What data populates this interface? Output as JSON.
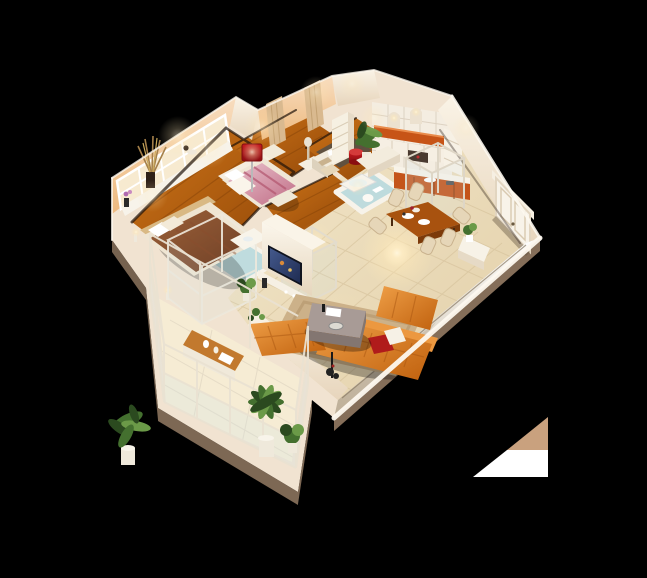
{
  "scene": {
    "type": "3d-isometric-apartment-cutaway-render",
    "view": "dollhouse-from-above",
    "background": "#000000"
  },
  "palette": {
    "bg": "#000000",
    "wall_cream": "#f1e3d1",
    "wall_bright": "#fcf8f0",
    "wall_peach": "#f4cba2",
    "wall_shade": "#cdab88",
    "slab_shade": "#937a63",
    "wood": "#b45f10",
    "wood_dark": "#7c3d07",
    "tile": "#ecdcbd",
    "tile_light": "#f6ecd4",
    "grout": "#d6c29c",
    "tile_blue": "#bedbdd",
    "rug": "#ccb189",
    "rug_dark": "#b2946a",
    "sofa": "#d97a26",
    "sofa_dark": "#a5520e",
    "grey_table": "#a89b96",
    "grey_table_dark": "#837671",
    "dining_wood": "#a8520f",
    "chair": "#e6d6b8",
    "chair_dark": "#c9b28e",
    "kitchen_orange": "#c4541a",
    "cornice": "#c75417",
    "lamp_red": "#ab1218",
    "bed_brown": "#7d4a2e",
    "bed_pink": "#d07b92",
    "white": "#f7f3ea",
    "plant": "#44702f",
    "plant_dark": "#2b4a1f",
    "plant_light": "#6b9a48",
    "glass": "#cfe3e8",
    "tv": "#10141f",
    "shadow": "#20130a",
    "glow": "#fff3d8",
    "artifact_tan": "#c9a17e",
    "artifact_white": "#ffffff"
  },
  "rooms": [
    {
      "name": "master-bedroom",
      "floor": "orange-wood",
      "furniture": [
        "double-bed-brown-cover",
        "glass-canopy-frame",
        "bedside-lamps",
        "window-wall-with-plants",
        "wardrobe"
      ]
    },
    {
      "name": "second-bedroom",
      "floor": "orange-wood",
      "furniture": [
        "double-bed-pink-cover",
        "red-floor-lamp",
        "curtains",
        "dresser-with-mirror"
      ]
    },
    {
      "name": "study",
      "floor": "orange-wood",
      "furniture": [
        "desk",
        "chair",
        "white-shelf-unit",
        "red-drum-stool",
        "potted-plant",
        "dark-area-rug",
        "low-cabinet"
      ]
    },
    {
      "name": "kitchen",
      "floor": "beige-tile",
      "furniture": [
        "tiled-backsplash-with-arched-niches",
        "orange-cornice",
        "upper-cabinets",
        "orange-lower-cabinets",
        "counter",
        "glass-cubicle",
        "pantry-shelves"
      ]
    },
    {
      "name": "bathroom",
      "floor": "blue-tile",
      "furniture": [
        "bathtub",
        "toilet"
      ]
    },
    {
      "name": "ensuite-bathroom",
      "floor": "blue-mosaic-tile",
      "furniture": [
        "glass-shower-cubicle",
        "vanity-basin"
      ]
    },
    {
      "name": "dining-area",
      "floor": "beige-tile",
      "furniture": [
        "wooden-dining-table",
        "six-upholstered-chairs",
        "tableware"
      ]
    },
    {
      "name": "living-room",
      "floor": "beige-tile",
      "furniture": [
        "l-shaped-orange-sofa",
        "ottoman-sectional",
        "grey-coffee-table",
        "beige-area-rug",
        "tv-on-partition-wall",
        "media-console",
        "red-and-white-pillows",
        "floor-sculpture"
      ]
    },
    {
      "name": "balcony",
      "floor": "light-tile",
      "furniture": [
        "glass-and-frame-railing",
        "wooden-bench-with-decor",
        "large-potted-plants"
      ]
    },
    {
      "name": "entry",
      "floor": "beige-tile",
      "furniture": [
        "white-panelled-double-door",
        "console-table",
        "small-potted-plant"
      ]
    }
  ],
  "artifact": {
    "description": "tan-and-white triangle render artifact at lower right",
    "colors": [
      "#c9a17e",
      "#ffffff"
    ]
  }
}
